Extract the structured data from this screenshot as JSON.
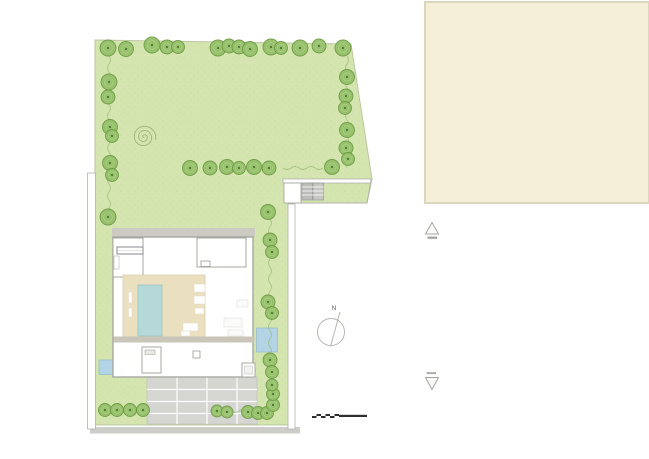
{
  "compass": {
    "label": "N"
  },
  "palette": {
    "grass": "#d4e5af",
    "grass-tex": "#c6db9c",
    "tree-fill": "#94c06a",
    "tree-stroke": "#6d9a43",
    "tree-ring": "#b7d792",
    "tree-dot": "#3e6a22",
    "vine": "#9cbd77",
    "spiral": "#96ad76",
    "beige": "#f6efd8",
    "beige-border": "#ddd6bf",
    "wall": "#b2b2ad",
    "house-stroke": "#a7a7a2",
    "deck": "#eadfbe",
    "pool": "#b5d8d8",
    "pond": "#b2d4e5",
    "paving": "#d5d5d2",
    "street": "#cdcdc9",
    "terrace": "#c9c5b8",
    "path-gray": "#cbcbc4",
    "ink": "#2e2e2e"
  },
  "spiral": {
    "cx": 144,
    "cy": 137,
    "turns": 2.8,
    "maxR": 12,
    "phase": 1.5
  },
  "vegetation": {
    "groups": [
      {
        "kind": "tree",
        "name": "top-row",
        "items": [
          [
            108,
            48,
            8
          ],
          [
            126,
            49,
            7.5
          ],
          [
            152,
            45,
            8
          ],
          [
            167,
            47,
            7
          ],
          [
            178,
            47,
            6.5
          ],
          [
            218,
            48,
            8
          ],
          [
            229,
            46,
            7
          ],
          [
            239,
            47,
            7
          ],
          [
            250,
            49,
            7.5
          ],
          [
            271,
            47,
            8
          ],
          [
            281,
            48,
            6.5
          ],
          [
            300,
            48,
            8
          ],
          [
            319,
            46,
            7
          ],
          [
            343,
            48,
            8
          ]
        ]
      },
      {
        "kind": "tree",
        "name": "left-column",
        "items": [
          [
            109,
            82,
            8
          ],
          [
            108,
            97,
            7
          ],
          [
            110,
            127,
            7.5
          ],
          [
            112,
            136,
            6.5
          ],
          [
            110,
            163,
            7.5
          ],
          [
            112,
            175,
            6.5
          ],
          [
            108,
            217,
            8
          ]
        ]
      },
      {
        "kind": "tree",
        "name": "right-column",
        "items": [
          [
            347,
            77,
            7.5
          ],
          [
            346,
            96,
            7
          ],
          [
            345,
            108,
            6.5
          ],
          [
            347,
            130,
            7.5
          ],
          [
            346,
            148,
            7
          ],
          [
            348,
            159,
            6.5
          ]
        ]
      },
      {
        "kind": "tree",
        "name": "middle-row",
        "items": [
          [
            190,
            168,
            7.5
          ],
          [
            210,
            168,
            7
          ],
          [
            227,
            167,
            7.5
          ],
          [
            239,
            168,
            6.5
          ],
          [
            254,
            167,
            7.5
          ],
          [
            269,
            168,
            7
          ],
          [
            332,
            167,
            7.5
          ],
          [
            268,
            212,
            7.5
          ]
        ]
      },
      {
        "kind": "tree",
        "name": "house-east-column",
        "items": [
          [
            270,
            240,
            7
          ],
          [
            272,
            252,
            6.5
          ],
          [
            268,
            302,
            7
          ],
          [
            272,
            313,
            6.5
          ],
          [
            270,
            360,
            7
          ],
          [
            272,
            372,
            6.5
          ]
        ]
      },
      {
        "kind": "shrub",
        "name": "south-hedge-west",
        "items": [
          [
            105,
            410,
            6.5
          ],
          [
            117,
            410,
            6.5
          ],
          [
            130,
            410,
            6.5
          ],
          [
            143,
            410,
            6.5
          ]
        ]
      },
      {
        "kind": "shrub",
        "name": "south-hedge-middle",
        "items": [
          [
            217,
            411,
            6
          ],
          [
            227,
            412,
            6
          ]
        ]
      },
      {
        "kind": "shrub",
        "name": "south-hedge-east",
        "items": [
          [
            248,
            412,
            6.5
          ],
          [
            258,
            413,
            6.5
          ],
          [
            267,
            413,
            6.5
          ],
          [
            273,
            405,
            6.5
          ],
          [
            273,
            394,
            6.5
          ],
          [
            272,
            385,
            6
          ]
        ]
      }
    ],
    "vines": [
      {
        "x": 109,
        "y0": 56,
        "y1": 210
      },
      {
        "x": 347,
        "y0": 56,
        "y1": 166
      },
      {
        "x": 270,
        "y0": 219,
        "y1": 398
      },
      {
        "y": 168,
        "x0": 283,
        "x1": 317
      },
      {
        "y": 411,
        "x0": 231,
        "x1": 259
      }
    ]
  }
}
